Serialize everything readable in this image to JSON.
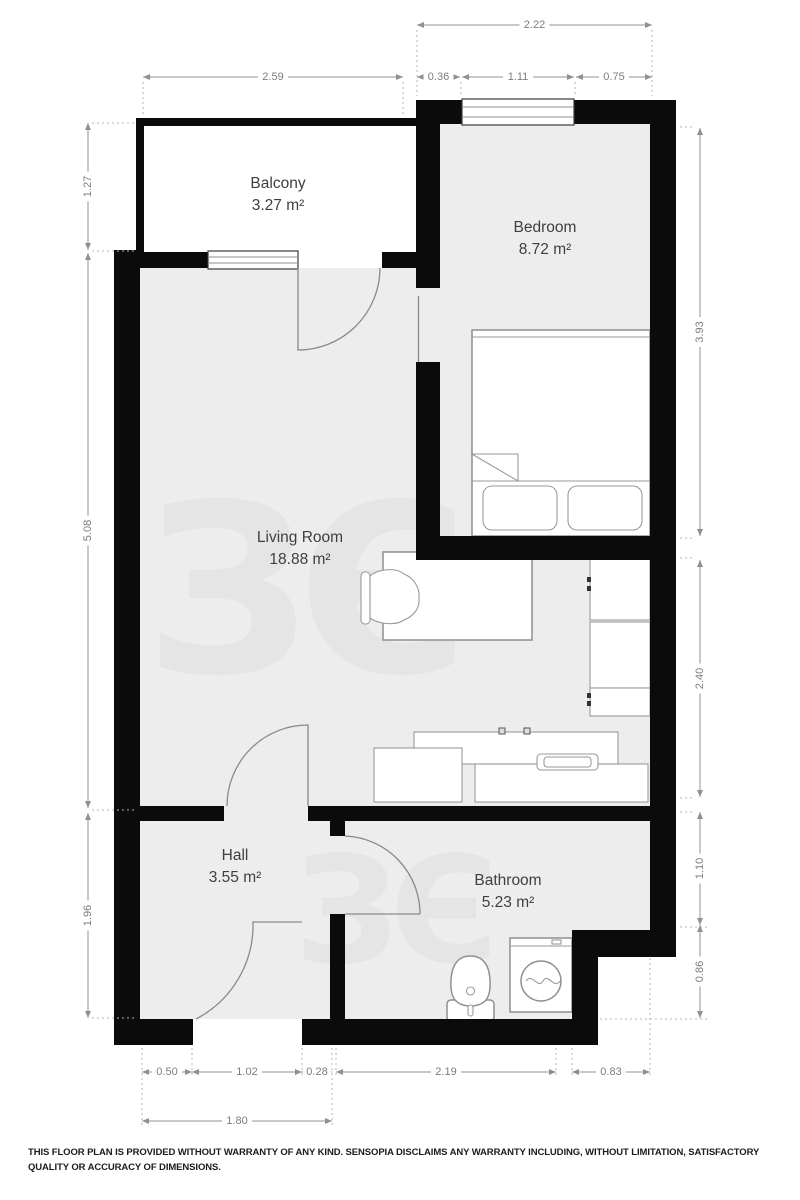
{
  "plan": {
    "watermark": "ЗЄ",
    "rooms": [
      {
        "id": "balcony",
        "name": "Balcony",
        "area": "3.27 m²"
      },
      {
        "id": "bedroom",
        "name": "Bedroom",
        "area": "8.72 m²"
      },
      {
        "id": "living-room",
        "name": "Living Room",
        "area": "18.88 m²"
      },
      {
        "id": "hall",
        "name": "Hall",
        "area": "3.55 m²"
      },
      {
        "id": "bathroom",
        "name": "Bathroom",
        "area": "5.23 m²"
      }
    ],
    "dims": {
      "top": [
        "2.22",
        "2.59",
        "0.36",
        "1.11",
        "0.75"
      ],
      "left": [
        "1.27",
        "5.08",
        "1.96"
      ],
      "right": [
        "3.93",
        "2.40",
        "1.10",
        "0.86"
      ],
      "bottom": [
        "0.50",
        "1.02",
        "0.28",
        "2.19",
        "0.83",
        "1.80"
      ]
    },
    "colors": {
      "wall": "#0b0b0b",
      "floor": "#ededed",
      "dimension": "#7d7d7d",
      "label": "#3f3f3f"
    }
  },
  "disclaimer": "THIS FLOOR PLAN IS PROVIDED WITHOUT WARRANTY OF ANY KIND. SENSOPIA DISCLAIMS ANY WARRANTY INCLUDING, WITHOUT LIMITATION, SATISFACTORY QUALITY OR ACCURACY OF DIMENSIONS."
}
